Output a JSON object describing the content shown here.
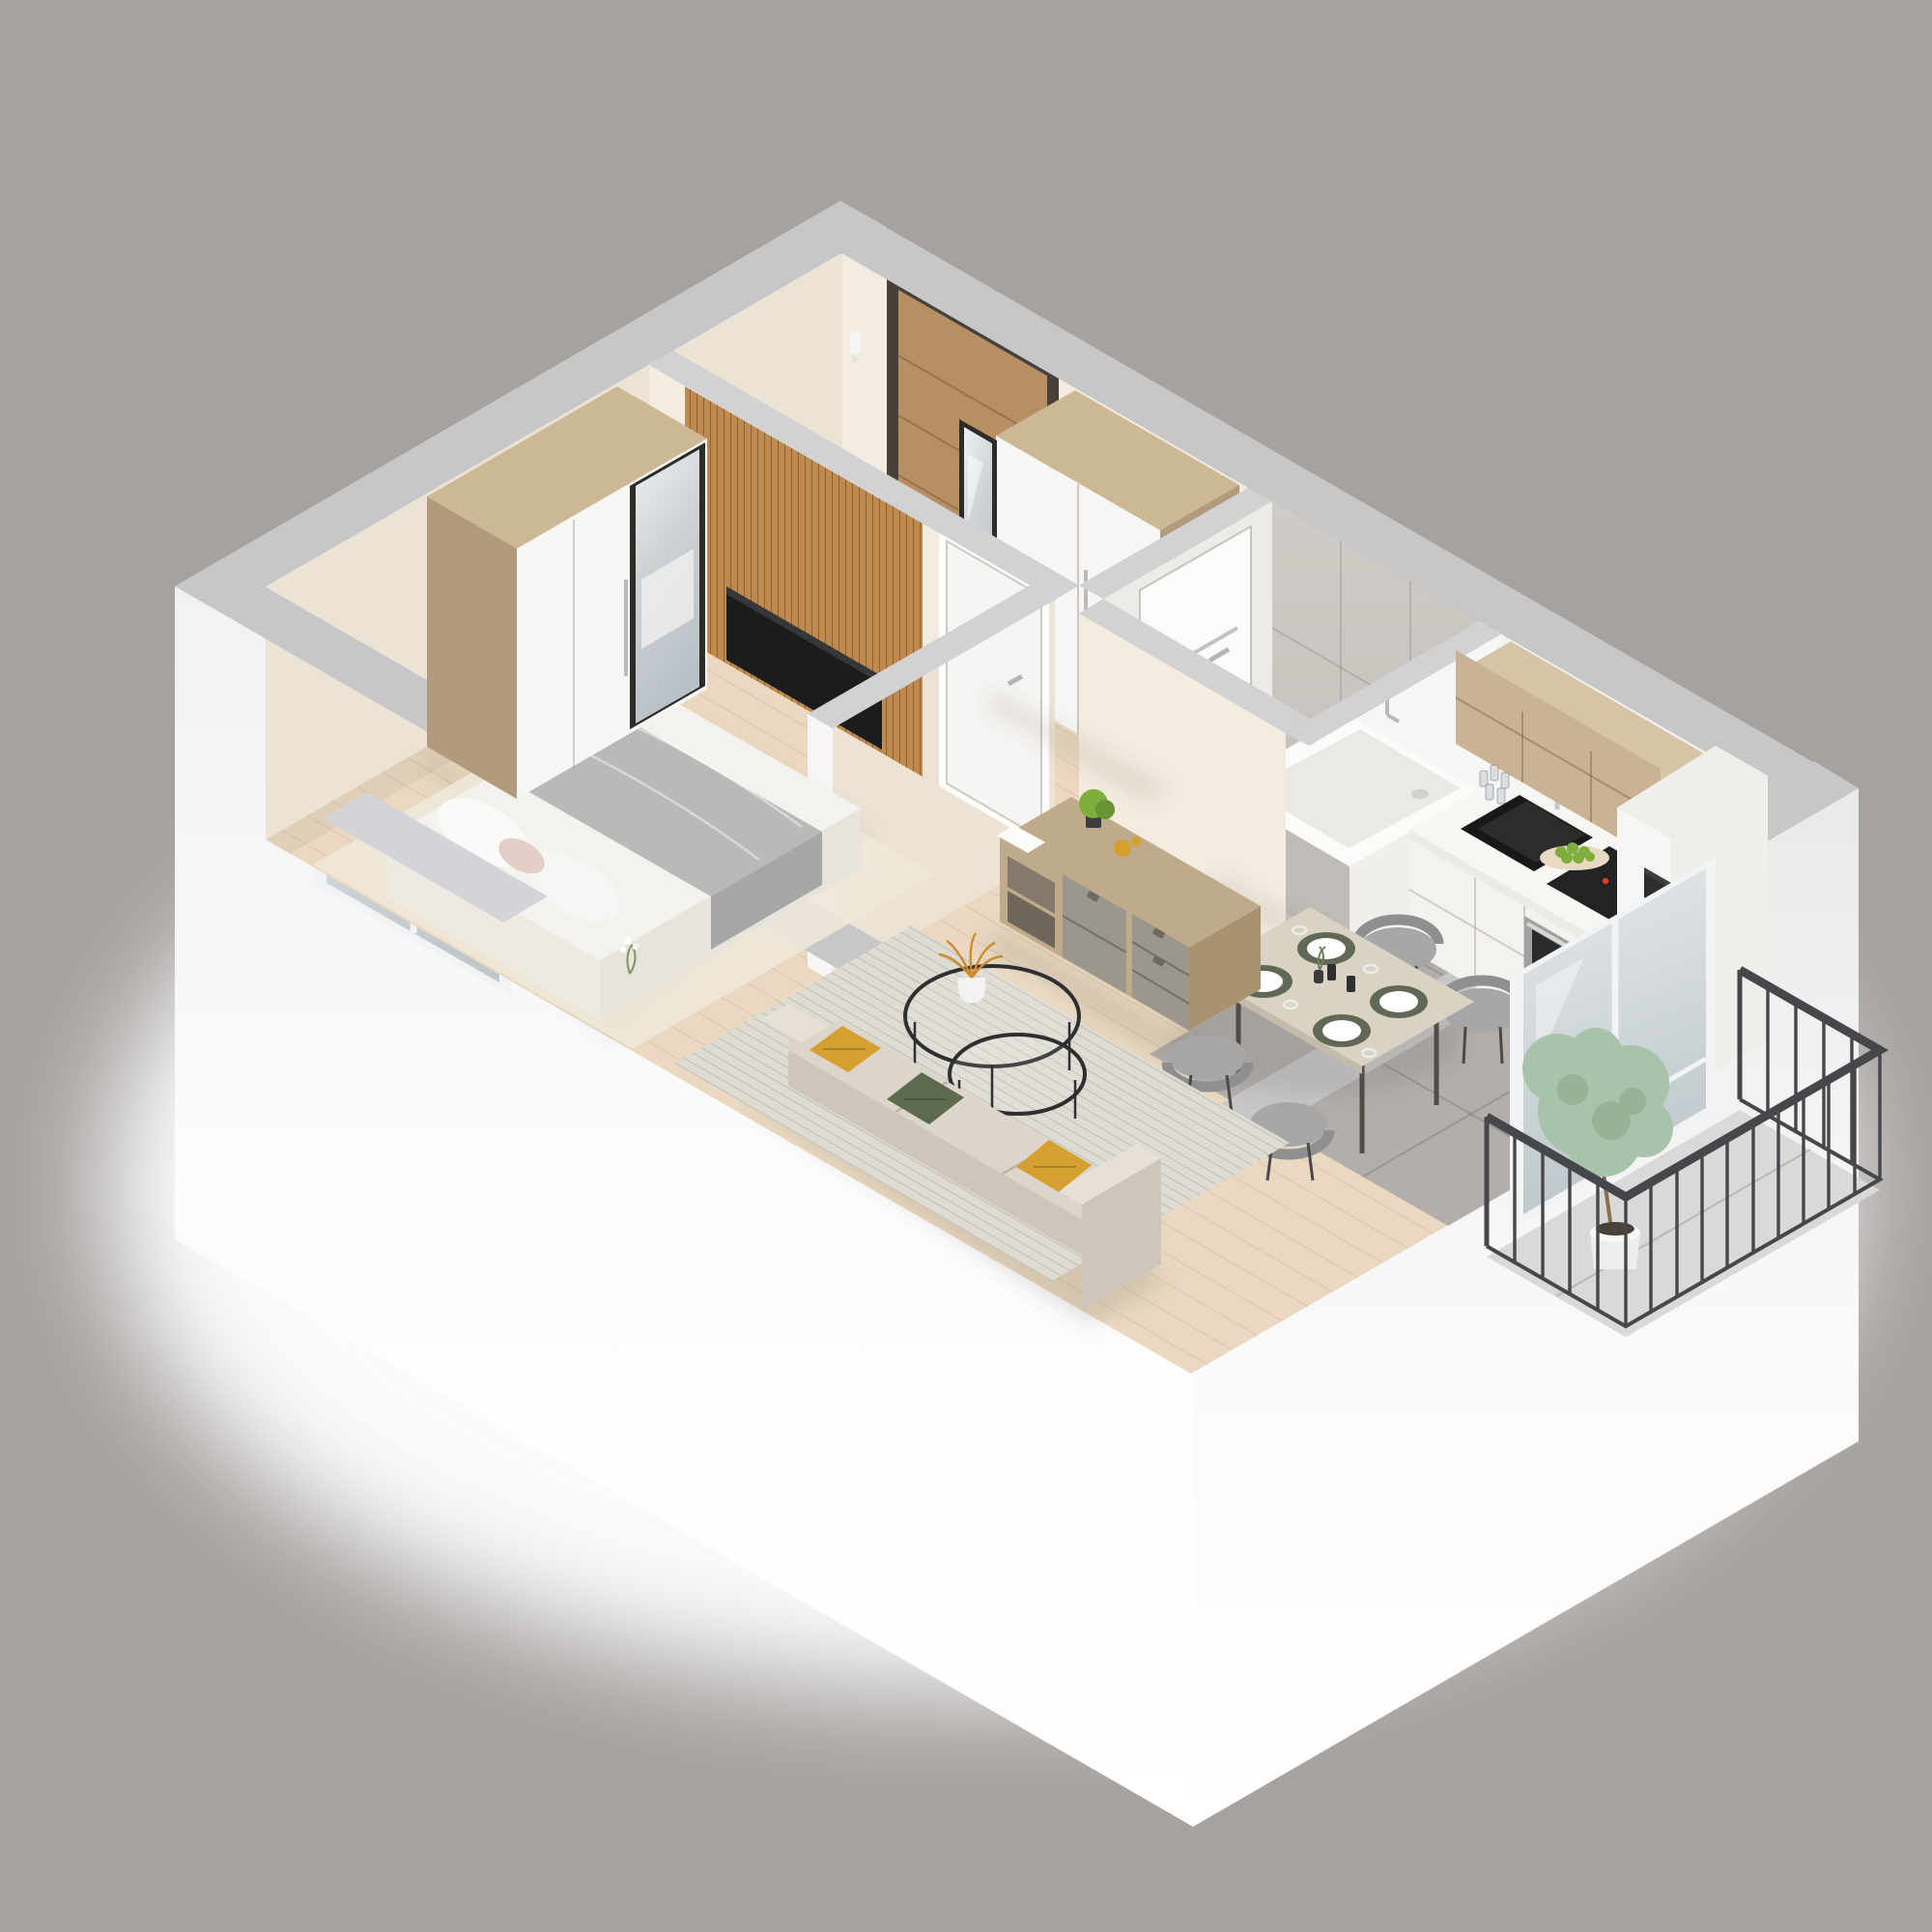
{
  "scene": {
    "kind": "isometric-cutaway-apartment-floorplan-render",
    "background": "#a6a2a0",
    "rooms": [
      {
        "name": "entry-hall",
        "furniture": [
          "front-door",
          "entry-wardrobe",
          "full-length-mirror",
          "intercom"
        ]
      },
      {
        "name": "bathroom",
        "furniture": [
          "bathtub",
          "marble-tile-walls",
          "bathroom-door",
          "towel-bar"
        ]
      },
      {
        "name": "kitchen",
        "furniture": [
          "upper-cabinets",
          "base-cabinets",
          "black-sink",
          "faucet",
          "induction-hob",
          "oven",
          "fruit-bowl",
          "glasses",
          "coffee-machine",
          "tall-cabinet"
        ]
      },
      {
        "name": "dining-area",
        "furniture": [
          "dining-table",
          "four-gray-chairs",
          "plates-placemats",
          "candles",
          "vase"
        ]
      },
      {
        "name": "living-room",
        "furniture": [
          "sofa",
          "cushions",
          "striped-rug",
          "nesting-coffee-tables",
          "sideboard",
          "dried-grass-vase"
        ]
      },
      {
        "name": "bedroom",
        "furniture": [
          "double-bed",
          "gray-throw",
          "pillows",
          "wardrobe-with-mirror",
          "tv-slat-wall",
          "area-rug",
          "window"
        ]
      },
      {
        "name": "balcony",
        "furniture": [
          "metal-railing",
          "potted-tree",
          "glass-balcony-door"
        ]
      }
    ],
    "colors": {
      "bg": "#a6a2a0",
      "glow": "#ffffff",
      "capExt": "#c7c6c8",
      "capInt": "#d2d1d3",
      "wallCream": "#f3ecdf",
      "wallCreamShade": "#ece3d4",
      "whitePanel": "#f7f6f4",
      "floorWood": "#ead9c0",
      "tileGray": "#b3aeaa",
      "bathFloor": "#c7c3be",
      "marbleWall": "#c9c5c0",
      "marbleWhite": "#edebe7",
      "tub": "#fbfbf9",
      "tubInner": "#e9e9e5",
      "tubApron": "#bfbbb6",
      "doorWood": "#b78f63",
      "doorFrame": "#474139",
      "metal": "#c6c8ca",
      "slat": "#bf8a50",
      "tv": "#1b1c1e",
      "woodTop": "#cdb896",
      "woodSide": "#b29b7b",
      "counter": "#f7f6f3",
      "cabWood": "#c9b394",
      "cabWoodSide": "#b19b7d",
      "backsplash": "#9a948c",
      "cabWhite": "#f3f2ef",
      "sink": "#17181a",
      "hob": "#222325",
      "hobRed": "#e23b1d",
      "ovenSteel": "#9fa1a3",
      "ovenGlass": "#2a2b2d",
      "bowl": "#e8d9c2",
      "fruit": "#7fae3c",
      "tableWood": "#dad2c2",
      "chair": "#a7a7a7",
      "chairDark": "#8e8f91",
      "placemat": "#606856",
      "plate": "#ffffff",
      "candle": "#2e2f31",
      "rugLiving": "#dedbd3",
      "rugBed": "#efe7d8",
      "sofa": "#dcd5cb",
      "sofaShade": "#cec6bb",
      "mustard": "#d4a02f",
      "green": "#5d6b4c",
      "pink": "#e3cfc6",
      "blanket": "#b9b9b9",
      "blanketDark": "#a7a7a7",
      "sheet": "#f4f2ee",
      "sheetShade": "#e8e4dc",
      "sideWood": "#c0aa8c",
      "sideWoodDark": "#a8926f",
      "drawerGray": "#9b968e",
      "drawerDark": "#6f6a61",
      "black": "#2c2d2f",
      "grassOrange": "#cf8a2e",
      "vase": "#f2f2f0",
      "railing": "#45474a",
      "balconyFloor": "#d9d9d7",
      "plant": "#a9c3aa",
      "plantDark": "#87a689",
      "pot": "#eceeec",
      "sill": "#d3d4d7",
      "shadow": "#5f574b"
    }
  }
}
